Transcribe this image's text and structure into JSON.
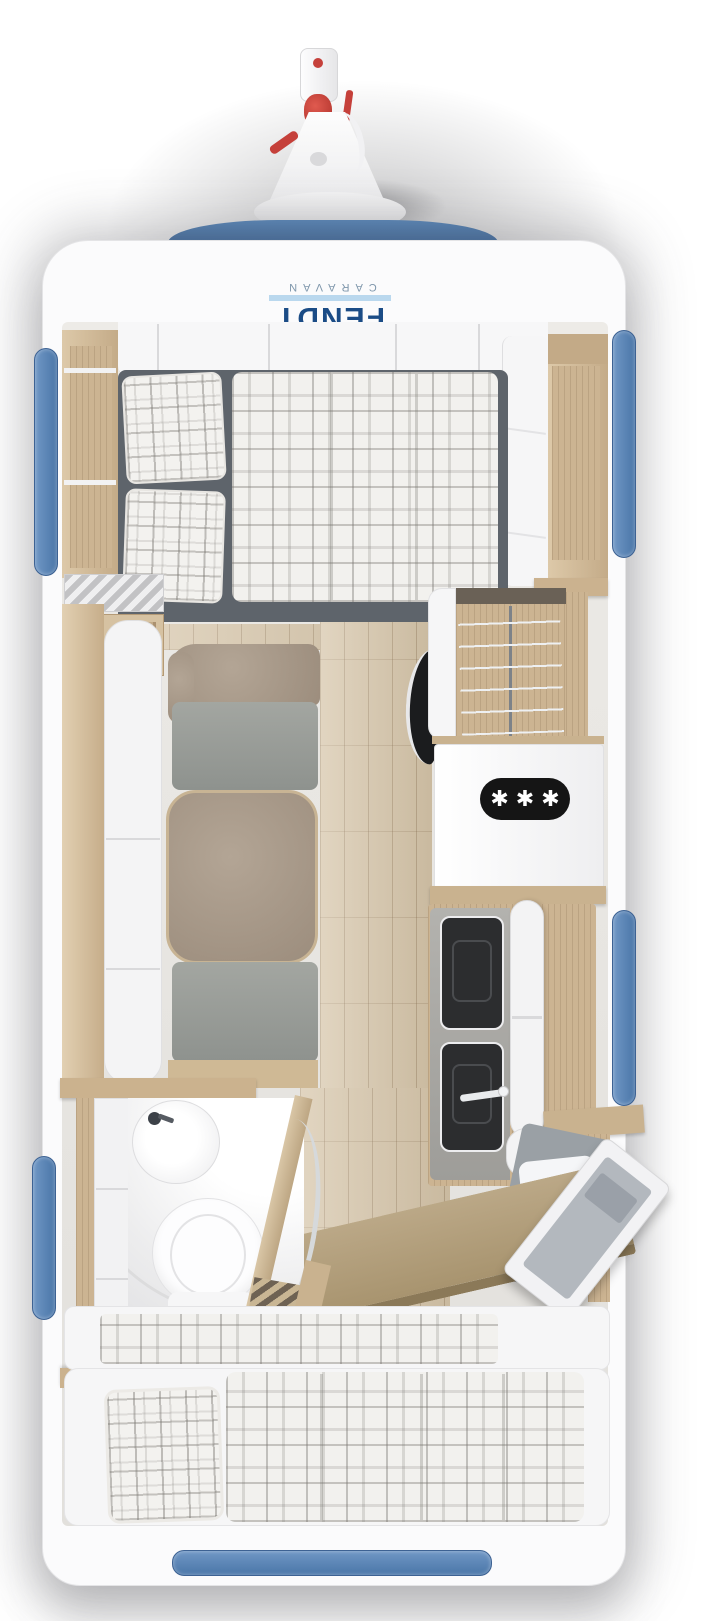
{
  "image": {
    "kind": "caravan floor plan, top-down 3D render",
    "width": 728,
    "height": 1621
  },
  "branding": {
    "logo_primary": "FENDT",
    "logo_secondary": "CARAVAN",
    "orientation": "rotated 180 degrees on front panel"
  },
  "badges": {
    "fridge_freezer_stars": "✱✱✱"
  },
  "colors": {
    "accent_blue_band": "#4d79ab",
    "window_blue": "#5b87ba",
    "logo_navy": "#1b4c86",
    "logo_gray_blue": "#7e96ab",
    "hitch_red": "#c5403a",
    "furniture_wood": "#ccb492",
    "floor_wood": "#d6c5a9",
    "mattress_gray": "#5e646b",
    "sofa_taupe": "#a89a8a",
    "sofa_gray": "#979b97",
    "counter_gray": "#a7a6a2",
    "shell_white": "#fbfbfc"
  },
  "features": [
    "tow-hitch drawbar with red coupling",
    "front blue trim band",
    "front transverse double bed with plaid pillows and duvet",
    "overhead locker row with seams",
    "left and right open wood shelves",
    "lounge with taupe-and-gray sofa and white sideboard top",
    "concertina blind / heater fins",
    "swivel TV on wardrobe side",
    "wardrobe with hanging rail and hangers",
    "fridge with 3-star freezer badge",
    "kitchen block with sink, hob, white glass lids and faucet",
    "bathroom with washbasin, toilet, curved shower floor, concertina door",
    "rear seat bench with white bedding near entrance",
    "open entrance door on right wall",
    "desk / bunk board (tan, angled)",
    "rear beds with plaid pillow and duvets",
    "blue windows: left front, left rear, right front, right mid, rear"
  ]
}
